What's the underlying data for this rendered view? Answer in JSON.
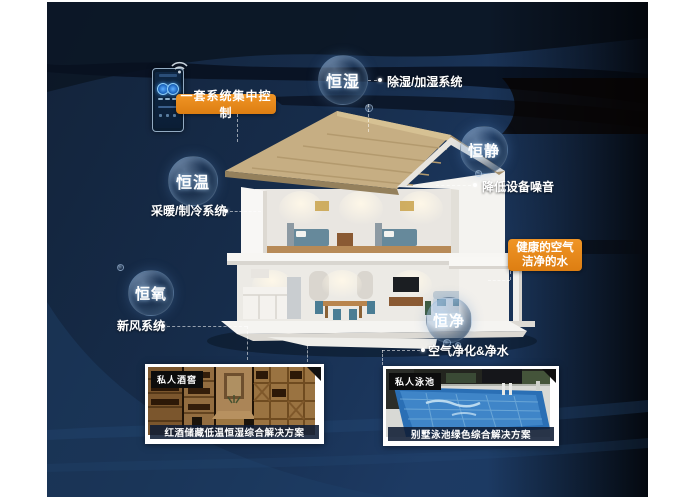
{
  "control": {
    "badge_label": "一套系统集中控制"
  },
  "health_badge": {
    "line1": "健康的空气",
    "line2": "洁净的水"
  },
  "bubbles": [
    {
      "label": "恒湿",
      "note": "除湿/加湿系统"
    },
    {
      "label": "恒静",
      "note": "降低设备噪音"
    },
    {
      "label": "恒温",
      "note": "采暖/制冷系统"
    },
    {
      "label": "恒氧",
      "note": "新风系统"
    },
    {
      "label": "恒净",
      "note": "空气净化&净水"
    }
  ],
  "cards": [
    {
      "tag": "私人酒窖",
      "caption": "红酒储藏低温恒湿综合解决方案"
    },
    {
      "tag": "私人泳池",
      "caption": "别墅泳池绿色综合解决方案"
    }
  ],
  "icons": {
    "wifi": "wifi-icon",
    "phone": "smart-control-panel"
  },
  "colors": {
    "accent_orange": "#E8861E",
    "background_navy": "#1C3A63",
    "roof_tan": "#C6AE83"
  }
}
